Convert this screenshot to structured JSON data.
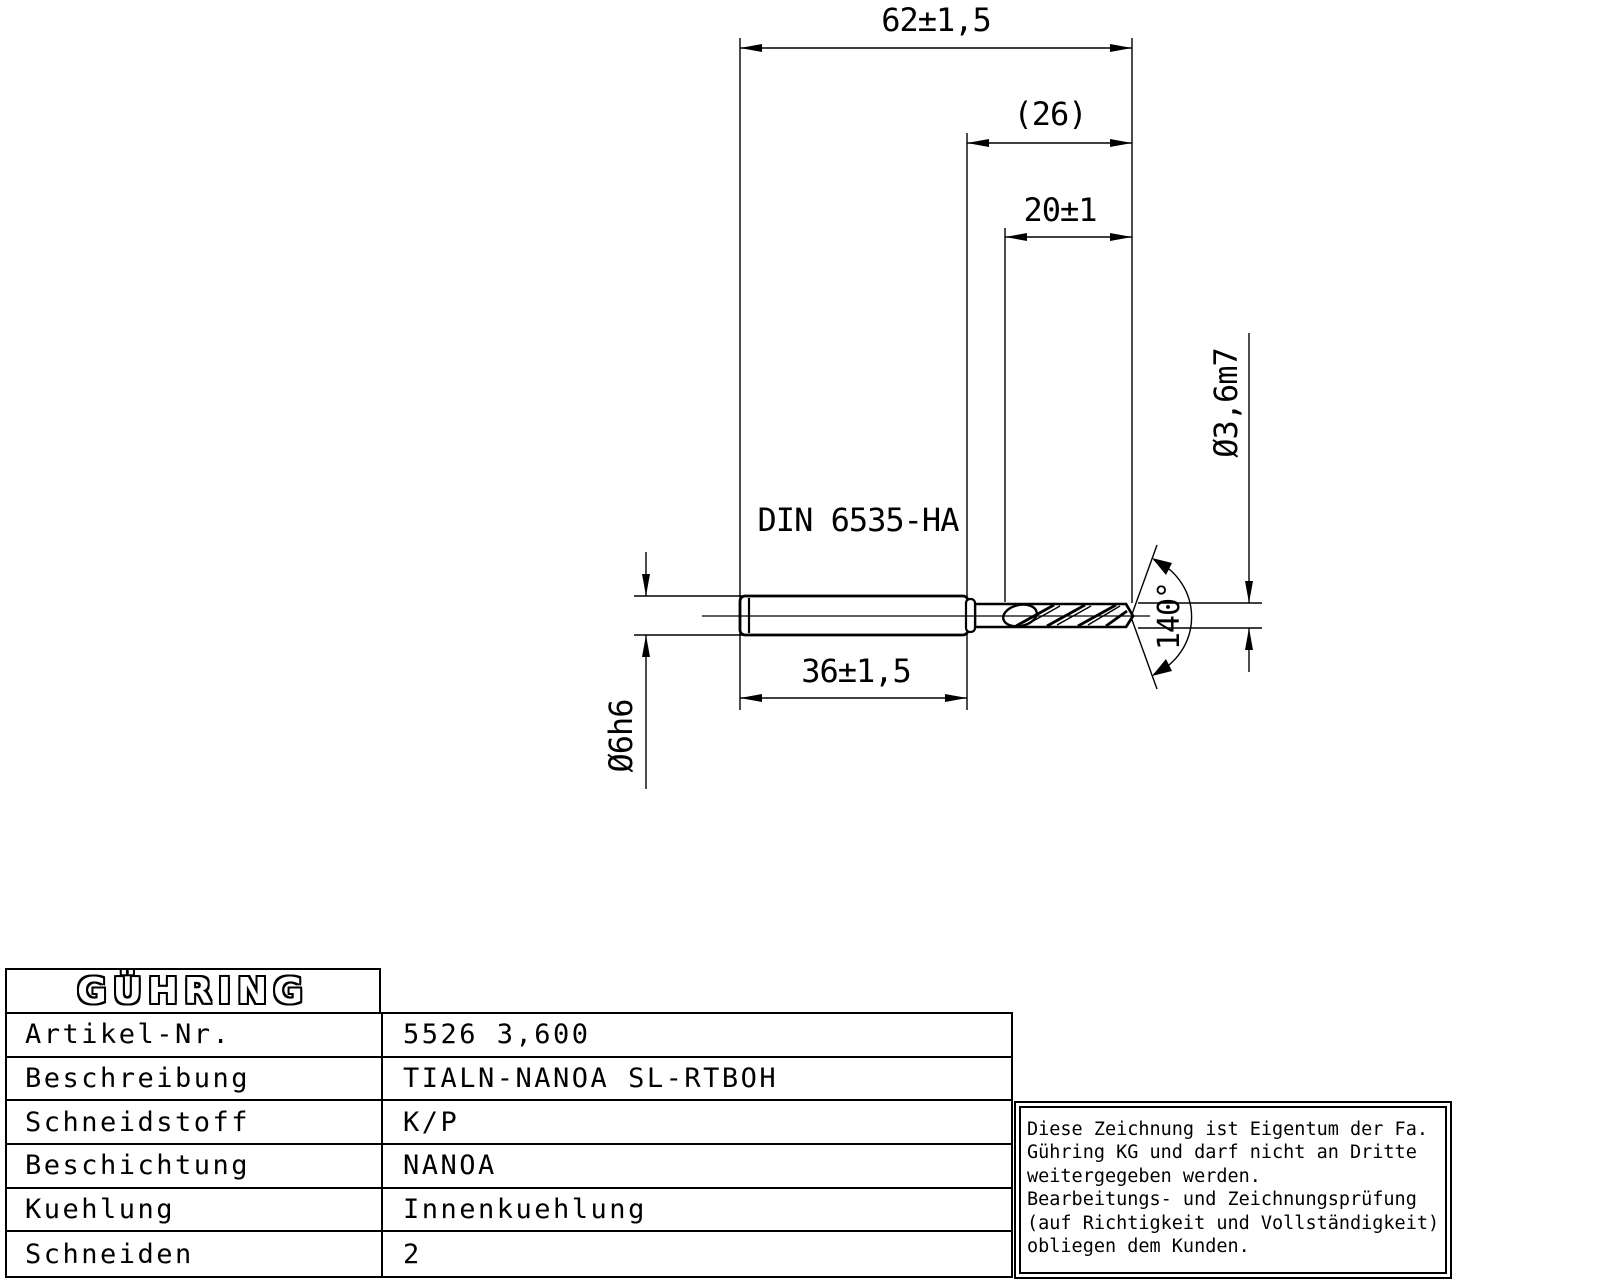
{
  "colors": {
    "line": "#000000",
    "background": "#ffffff"
  },
  "drawing": {
    "overall_length": "62±1,5",
    "ref_length": "(26)",
    "flute_length": "20±1",
    "drill_diameter": "Ø3,6m7",
    "point_angle": "140°",
    "shank_length": "36±1,5",
    "shank_diameter": "Ø6h6",
    "shank_norm": "DIN 6535-HA"
  },
  "table": {
    "logo": "GÜHRING",
    "rows": [
      {
        "label": "Artikel-Nr.",
        "value": "5526 3,600"
      },
      {
        "label": "Beschreibung",
        "value": "TIALN-NANOA SL-RTBOH"
      },
      {
        "label": "Schneidstoff",
        "value": "K/P"
      },
      {
        "label": "Beschichtung",
        "value": "NANOA"
      },
      {
        "label": "Kuehlung",
        "value": "Innenkuehlung"
      },
      {
        "label": "Schneiden",
        "value": "2"
      }
    ]
  },
  "disclaimer": {
    "lines": [
      "Diese Zeichnung ist Eigentum der Fa.",
      "Gühring KG und darf nicht an Dritte",
      "weitergegeben werden.",
      "Bearbeitungs- und Zeichnungsprüfung",
      "(auf Richtigkeit und Vollständigkeit)",
      "obliegen dem Kunden."
    ]
  }
}
